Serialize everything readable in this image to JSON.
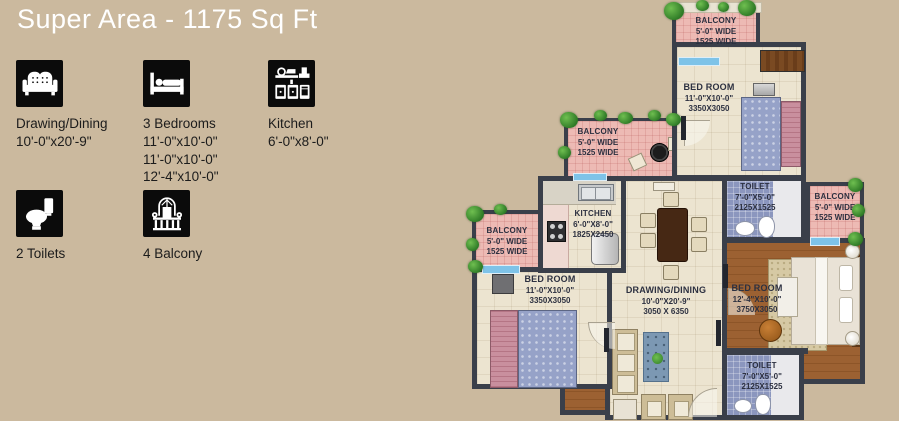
{
  "title": "Super Area - 1175 Sq Ft",
  "legend": {
    "items": [
      {
        "icon": "sofa-icon",
        "label": "Drawing/Dining",
        "dims": [
          "10'-0\"x20'-9\""
        ]
      },
      {
        "icon": "bed-icon",
        "label": "3 Bedrooms",
        "dims": [
          "11'-0\"x10'-0\"",
          "11'-0\"x10'-0\"",
          "12'-4\"x10'-0\""
        ]
      },
      {
        "icon": "kitchen-icon",
        "label": "Kitchen",
        "dims": [
          "6'-0\"x8'-0\""
        ]
      },
      {
        "icon": "toilet-icon",
        "label": "2 Toilets",
        "dims": []
      },
      {
        "icon": "balcony-icon",
        "label": "4 Balcony",
        "dims": []
      }
    ]
  },
  "plan": {
    "rooms": {
      "balcony_top": {
        "name": "BALCONY",
        "dim_ft": "5'-0\" WIDE",
        "dim_mm": "1525 WIDE"
      },
      "bedroom_top": {
        "name": "BED ROOM",
        "dim_ft": "11'-0\"X10'-0\"",
        "dim_mm": "3350X3050"
      },
      "balcony_mid": {
        "name": "BALCONY",
        "dim_ft": "5'-0\" WIDE",
        "dim_mm": "1525 WIDE"
      },
      "toilet_top": {
        "name": "TOILET",
        "dim_ft": "7'-0\"X5'-0\"",
        "dim_mm": "2125X1525"
      },
      "balcony_right": {
        "name": "BALCONY",
        "dim_ft": "5'-0\" WIDE",
        "dim_mm": "1525 WIDE"
      },
      "kitchen": {
        "name": "KITCHEN",
        "dim_ft": "6'-0\"X8'-0\"",
        "dim_mm": "1825X2450"
      },
      "balcony_left": {
        "name": "BALCONY",
        "dim_ft": "5'-0\" WIDE",
        "dim_mm": "1525 WIDE"
      },
      "bedroom_left": {
        "name": "BED ROOM",
        "dim_ft": "11'-0\"X10'-0\"",
        "dim_mm": "3350X3050"
      },
      "drawing_dining": {
        "name": "DRAWING/DINING",
        "dim_ft": "10'-0\"X20'-9\"",
        "dim_mm": "3050 X 6350"
      },
      "bedroom_master": {
        "name": "BED ROOM",
        "dim_ft": "12'-4\"X10'-0\"",
        "dim_mm": "3750X3050"
      },
      "toilet_bottom": {
        "name": "TOILET",
        "dim_ft": "7'-0\"X5'-0\"",
        "dim_mm": "2125X1525"
      }
    }
  },
  "colors": {
    "background": "#cbb99e",
    "wall": "#3a3f4a",
    "balcony_floor": "#edbab4",
    "room_floor": "#ece4d0",
    "toilet_tile": "#8b96be",
    "wood_floor": "#9c6132",
    "sliding_door": "#7ec3e8",
    "title_text": "#ffffff",
    "legend_icon_bg": "#0b0b0b"
  }
}
